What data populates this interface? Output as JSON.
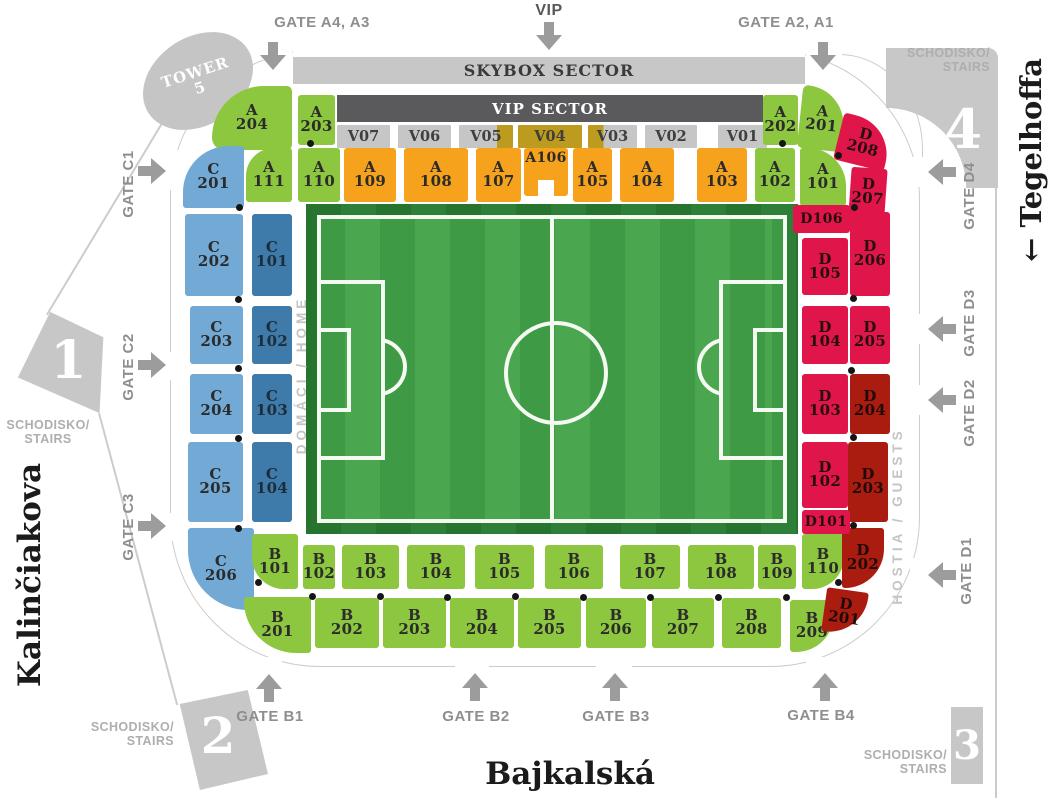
{
  "streets": {
    "left": "Kalinčiakova",
    "right": "← Tegelhoffa",
    "bottom": "Bajkalská"
  },
  "tower": {
    "line1": "TOWER",
    "line2": "5"
  },
  "stairs": {
    "line1": "SCHODISKO/",
    "line2": "STAIRS"
  },
  "corners": {
    "one": "1",
    "two": "2",
    "three": "3",
    "four": "4"
  },
  "stands": {
    "skybox_label": "SKYBOX SECTOR",
    "vip_label": "VIP SECTOR",
    "vip_boxes": [
      "V07",
      "V06",
      "V05",
      "V04",
      "V03",
      "V02",
      "V01"
    ],
    "home_label": "DOMÁCI / HOME",
    "guests_label": "HOSTIA / GUESTS"
  },
  "gates": {
    "top": [
      {
        "id": "gate-a4-a3",
        "label": "GATE A4, A3"
      },
      {
        "id": "gate-vip",
        "label": "VIP"
      },
      {
        "id": "gate-a2-a1",
        "label": "GATE A2, A1"
      }
    ],
    "left": [
      {
        "id": "gate-c1",
        "label": "GATE C1"
      },
      {
        "id": "gate-c2",
        "label": "GATE C2"
      },
      {
        "id": "gate-c3",
        "label": "GATE C3"
      }
    ],
    "right": [
      {
        "id": "gate-d4",
        "label": "GATE D4"
      },
      {
        "id": "gate-d3",
        "label": "GATE D3"
      },
      {
        "id": "gate-d2",
        "label": "GATE D2"
      },
      {
        "id": "gate-d1",
        "label": "GATE D1"
      }
    ],
    "bottom": [
      {
        "id": "gate-b1",
        "label": "GATE B1"
      },
      {
        "id": "gate-b2",
        "label": "GATE B2"
      },
      {
        "id": "gate-b3",
        "label": "GATE B3"
      },
      {
        "id": "gate-b4",
        "label": "GATE B4"
      }
    ]
  },
  "sections": [
    {
      "id": "A204",
      "label": "A 204",
      "category": "green"
    },
    {
      "id": "A203",
      "label": "A 203",
      "category": "green"
    },
    {
      "id": "A202",
      "label": "A 202",
      "category": "green"
    },
    {
      "id": "A201",
      "label": "A 201",
      "category": "green"
    },
    {
      "id": "A111",
      "label": "A 111",
      "category": "green"
    },
    {
      "id": "A110",
      "label": "A 110",
      "category": "green"
    },
    {
      "id": "A109",
      "label": "A 109",
      "category": "orange"
    },
    {
      "id": "A108",
      "label": "A 108",
      "category": "orange"
    },
    {
      "id": "A107",
      "label": "A 107",
      "category": "orange"
    },
    {
      "id": "A106",
      "label": "A106",
      "category": "orange"
    },
    {
      "id": "A105",
      "label": "A 105",
      "category": "orange"
    },
    {
      "id": "A104",
      "label": "A 104",
      "category": "orange"
    },
    {
      "id": "A103",
      "label": "A 103",
      "category": "orange"
    },
    {
      "id": "A102",
      "label": "A 102",
      "category": "green"
    },
    {
      "id": "A101",
      "label": "A 101",
      "category": "green"
    },
    {
      "id": "C201",
      "label": "C 201",
      "category": "light-blue"
    },
    {
      "id": "C202",
      "label": "C 202",
      "category": "light-blue"
    },
    {
      "id": "C203",
      "label": "C 203",
      "category": "light-blue"
    },
    {
      "id": "C204",
      "label": "C 204",
      "category": "light-blue"
    },
    {
      "id": "C205",
      "label": "C 205",
      "category": "light-blue"
    },
    {
      "id": "C206",
      "label": "C 206",
      "category": "light-blue"
    },
    {
      "id": "C101",
      "label": "C 101",
      "category": "dark-blue"
    },
    {
      "id": "C102",
      "label": "C 102",
      "category": "dark-blue"
    },
    {
      "id": "C103",
      "label": "C 103",
      "category": "dark-blue"
    },
    {
      "id": "C104",
      "label": "C 104",
      "category": "dark-blue"
    },
    {
      "id": "B101",
      "label": "B 101",
      "category": "green"
    },
    {
      "id": "B102",
      "label": "B 102",
      "category": "green"
    },
    {
      "id": "B103",
      "label": "B 103",
      "category": "green"
    },
    {
      "id": "B104",
      "label": "B 104",
      "category": "green"
    },
    {
      "id": "B105",
      "label": "B 105",
      "category": "green"
    },
    {
      "id": "B106",
      "label": "B 106",
      "category": "green"
    },
    {
      "id": "B107",
      "label": "B 107",
      "category": "green"
    },
    {
      "id": "B108",
      "label": "B 108",
      "category": "green"
    },
    {
      "id": "B109",
      "label": "B 109",
      "category": "green"
    },
    {
      "id": "B110",
      "label": "B 110",
      "category": "green"
    },
    {
      "id": "B201",
      "label": "B 201",
      "category": "green"
    },
    {
      "id": "B202",
      "label": "B 202",
      "category": "green"
    },
    {
      "id": "B203",
      "label": "B 203",
      "category": "green"
    },
    {
      "id": "B204",
      "label": "B 204",
      "category": "green"
    },
    {
      "id": "B205",
      "label": "B 205",
      "category": "green"
    },
    {
      "id": "B206",
      "label": "B 206",
      "category": "green"
    },
    {
      "id": "B207",
      "label": "B 207",
      "category": "green"
    },
    {
      "id": "B208",
      "label": "B 208",
      "category": "green"
    },
    {
      "id": "B209",
      "label": "B 209",
      "category": "green"
    },
    {
      "id": "D208",
      "label": "D 208",
      "category": "crimson"
    },
    {
      "id": "D207",
      "label": "D 207",
      "category": "crimson"
    },
    {
      "id": "D206",
      "label": "D 206",
      "category": "crimson"
    },
    {
      "id": "D205",
      "label": "D 205",
      "category": "crimson"
    },
    {
      "id": "D204",
      "label": "D 204",
      "category": "dark-red"
    },
    {
      "id": "D203",
      "label": "D 203",
      "category": "dark-red"
    },
    {
      "id": "D202",
      "label": "D 202",
      "category": "dark-red"
    },
    {
      "id": "D201",
      "label": "D 201",
      "category": "dark-red"
    },
    {
      "id": "D106",
      "label": "D106",
      "category": "crimson"
    },
    {
      "id": "D105",
      "label": "D 105",
      "category": "crimson"
    },
    {
      "id": "D104",
      "label": "D 104",
      "category": "crimson"
    },
    {
      "id": "D103",
      "label": "D 103",
      "category": "crimson"
    },
    {
      "id": "D102",
      "label": "D 102",
      "category": "crimson"
    },
    {
      "id": "D101",
      "label": "D101",
      "category": "crimson"
    }
  ],
  "colors": {
    "green": "#8dc63f",
    "orange": "#f6a21c",
    "light_blue": "#72aad5",
    "dark_blue": "#3e7bab",
    "crimson": "#e0164a",
    "dark_red": "#aa1b10",
    "vip_olive": "#bd9b1f",
    "gray_block": "#c7c7c7",
    "dark_gray_bar": "#5a5a5c",
    "pitch_green": "#3f9a46"
  }
}
